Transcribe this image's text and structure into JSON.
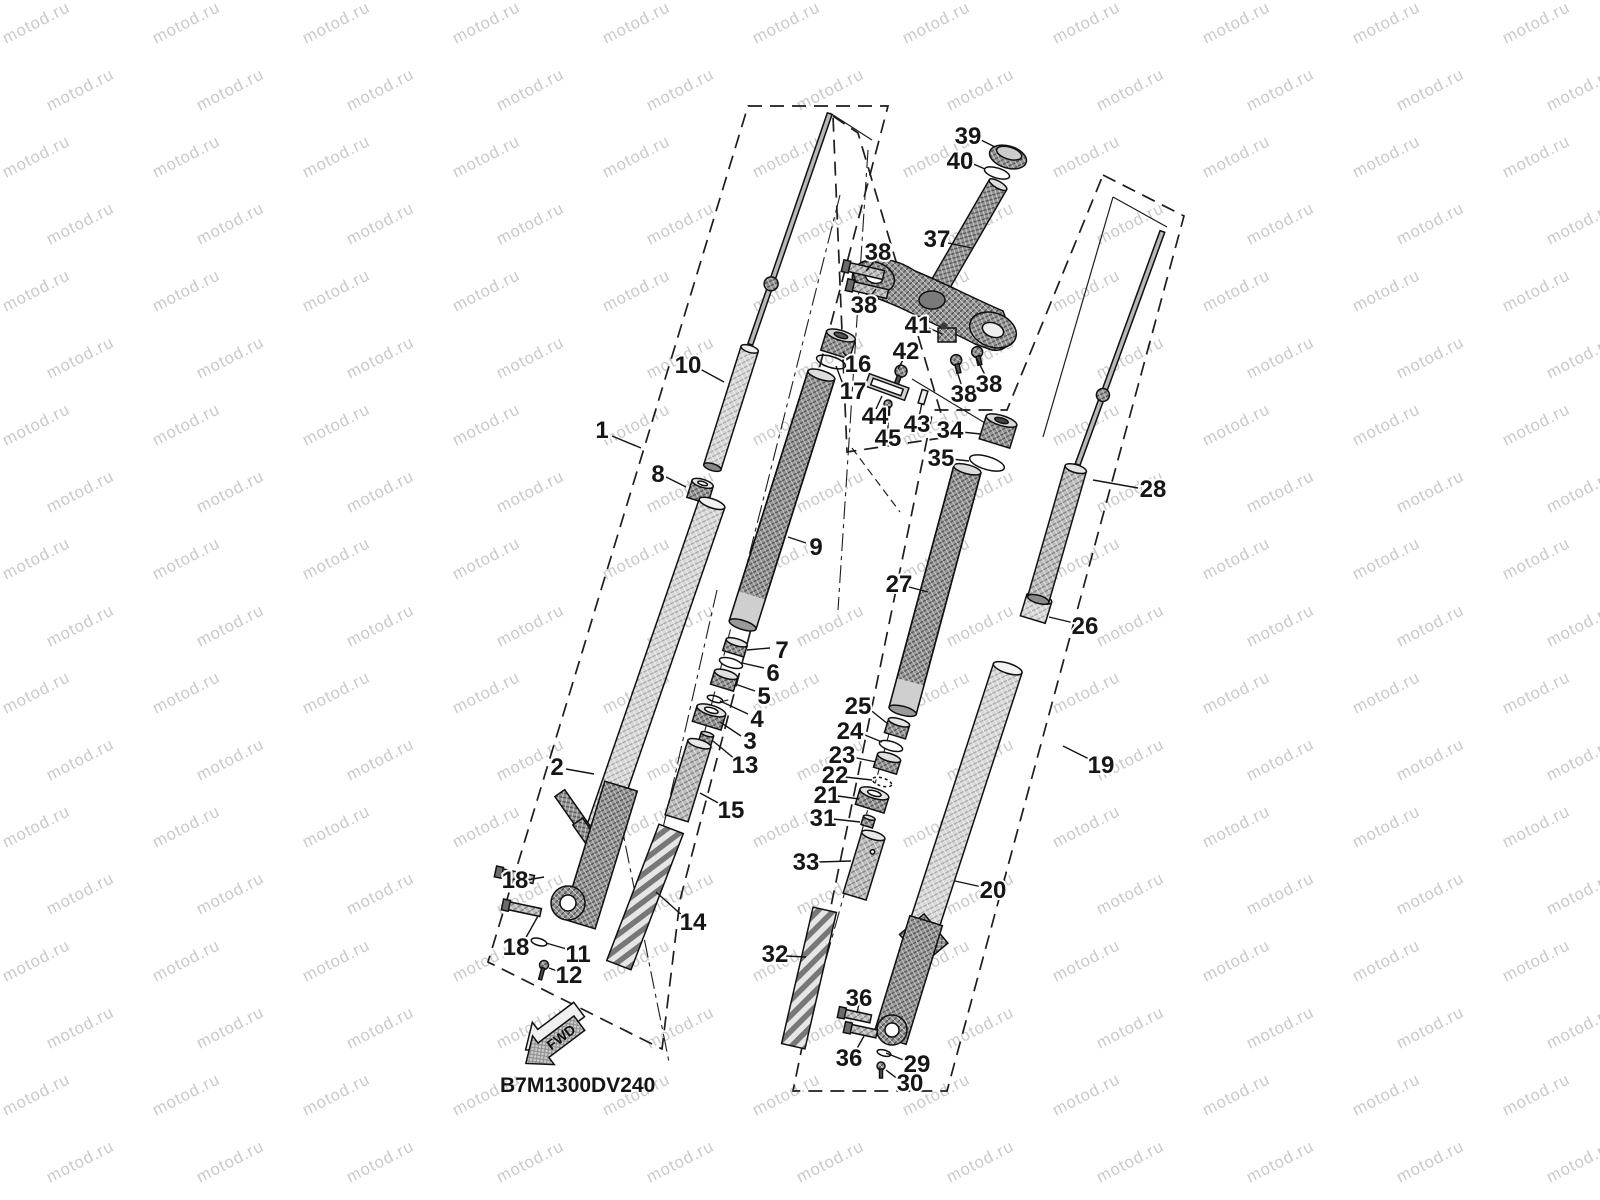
{
  "document": {
    "code": "B7M1300DV240",
    "fwd_label": "FWD"
  },
  "watermark": {
    "text": "motod.ru",
    "color": "#c9c9c9"
  },
  "diagram": {
    "title": "Front fork exploded parts diagram",
    "line_color": "#1a1a1a",
    "background": "#ffffff",
    "callouts": [
      {
        "n": "1",
        "x": 602,
        "y": 430
      },
      {
        "n": "2",
        "x": 557,
        "y": 767
      },
      {
        "n": "3",
        "x": 750,
        "y": 741
      },
      {
        "n": "4",
        "x": 757,
        "y": 719
      },
      {
        "n": "5",
        "x": 764,
        "y": 696
      },
      {
        "n": "6",
        "x": 773,
        "y": 673
      },
      {
        "n": "7",
        "x": 782,
        "y": 650
      },
      {
        "n": "8",
        "x": 658,
        "y": 474
      },
      {
        "n": "9",
        "x": 816,
        "y": 547
      },
      {
        "n": "10",
        "x": 688,
        "y": 365
      },
      {
        "n": "11",
        "x": 578,
        "y": 954
      },
      {
        "n": "12",
        "x": 569,
        "y": 975
      },
      {
        "n": "13",
        "x": 745,
        "y": 765
      },
      {
        "n": "14",
        "x": 693,
        "y": 922
      },
      {
        "n": "15",
        "x": 731,
        "y": 810
      },
      {
        "n": "16",
        "x": 858,
        "y": 364
      },
      {
        "n": "17",
        "x": 853,
        "y": 391
      },
      {
        "n": "18",
        "x": 515,
        "y": 880
      },
      {
        "n": "18",
        "x": 516,
        "y": 947
      },
      {
        "n": "19",
        "x": 1101,
        "y": 765
      },
      {
        "n": "20",
        "x": 993,
        "y": 890
      },
      {
        "n": "21",
        "x": 827,
        "y": 795
      },
      {
        "n": "22",
        "x": 835,
        "y": 775
      },
      {
        "n": "23",
        "x": 842,
        "y": 755
      },
      {
        "n": "24",
        "x": 850,
        "y": 731
      },
      {
        "n": "25",
        "x": 858,
        "y": 706
      },
      {
        "n": "26",
        "x": 1085,
        "y": 626
      },
      {
        "n": "27",
        "x": 899,
        "y": 584
      },
      {
        "n": "28",
        "x": 1153,
        "y": 489
      },
      {
        "n": "29",
        "x": 917,
        "y": 1064
      },
      {
        "n": "30",
        "x": 910,
        "y": 1083
      },
      {
        "n": "31",
        "x": 823,
        "y": 818
      },
      {
        "n": "32",
        "x": 775,
        "y": 954
      },
      {
        "n": "33",
        "x": 806,
        "y": 862
      },
      {
        "n": "34",
        "x": 950,
        "y": 430
      },
      {
        "n": "35",
        "x": 941,
        "y": 458
      },
      {
        "n": "36",
        "x": 859,
        "y": 998
      },
      {
        "n": "36",
        "x": 849,
        "y": 1058
      },
      {
        "n": "37",
        "x": 937,
        "y": 239
      },
      {
        "n": "38",
        "x": 878,
        "y": 252
      },
      {
        "n": "38",
        "x": 864,
        "y": 305
      },
      {
        "n": "38",
        "x": 964,
        "y": 394
      },
      {
        "n": "38",
        "x": 989,
        "y": 384
      },
      {
        "n": "39",
        "x": 968,
        "y": 136
      },
      {
        "n": "40",
        "x": 960,
        "y": 161
      },
      {
        "n": "41",
        "x": 918,
        "y": 325
      },
      {
        "n": "42",
        "x": 906,
        "y": 351
      },
      {
        "n": "43",
        "x": 917,
        "y": 424
      },
      {
        "n": "44",
        "x": 875,
        "y": 416
      },
      {
        "n": "45",
        "x": 888,
        "y": 438
      }
    ]
  }
}
